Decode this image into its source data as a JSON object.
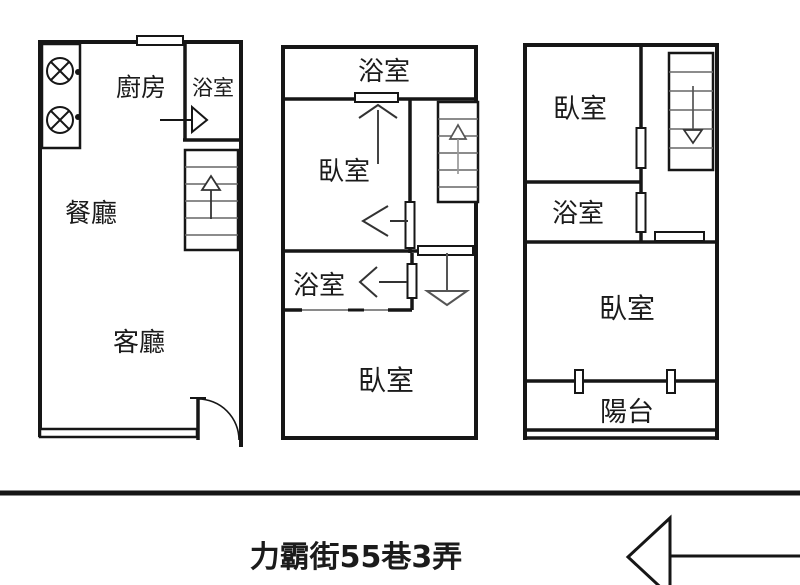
{
  "floors": [
    {
      "id": "floor-1",
      "rooms": [
        {
          "key": "kitchen",
          "label": "廚房"
        },
        {
          "key": "bathroom",
          "label": "浴室"
        },
        {
          "key": "dining-room",
          "label": "餐廳"
        },
        {
          "key": "living-room",
          "label": "客廳"
        }
      ]
    },
    {
      "id": "floor-2",
      "rooms": [
        {
          "key": "bathroom-top",
          "label": "浴室"
        },
        {
          "key": "bedroom",
          "label": "臥室"
        },
        {
          "key": "bathroom-mid",
          "label": "浴室"
        },
        {
          "key": "bedroom-rear",
          "label": "臥室"
        }
      ]
    },
    {
      "id": "floor-3",
      "rooms": [
        {
          "key": "bedroom-front",
          "label": "臥室"
        },
        {
          "key": "bathroom",
          "label": "浴室"
        },
        {
          "key": "bedroom-main",
          "label": "臥室"
        },
        {
          "key": "balcony",
          "label": "陽台"
        }
      ]
    }
  ],
  "street": {
    "label": "力霸街55巷3弄"
  },
  "colors": {
    "wall": "#161616",
    "light_line": "#8a8a8a",
    "background": "#ffffff"
  }
}
